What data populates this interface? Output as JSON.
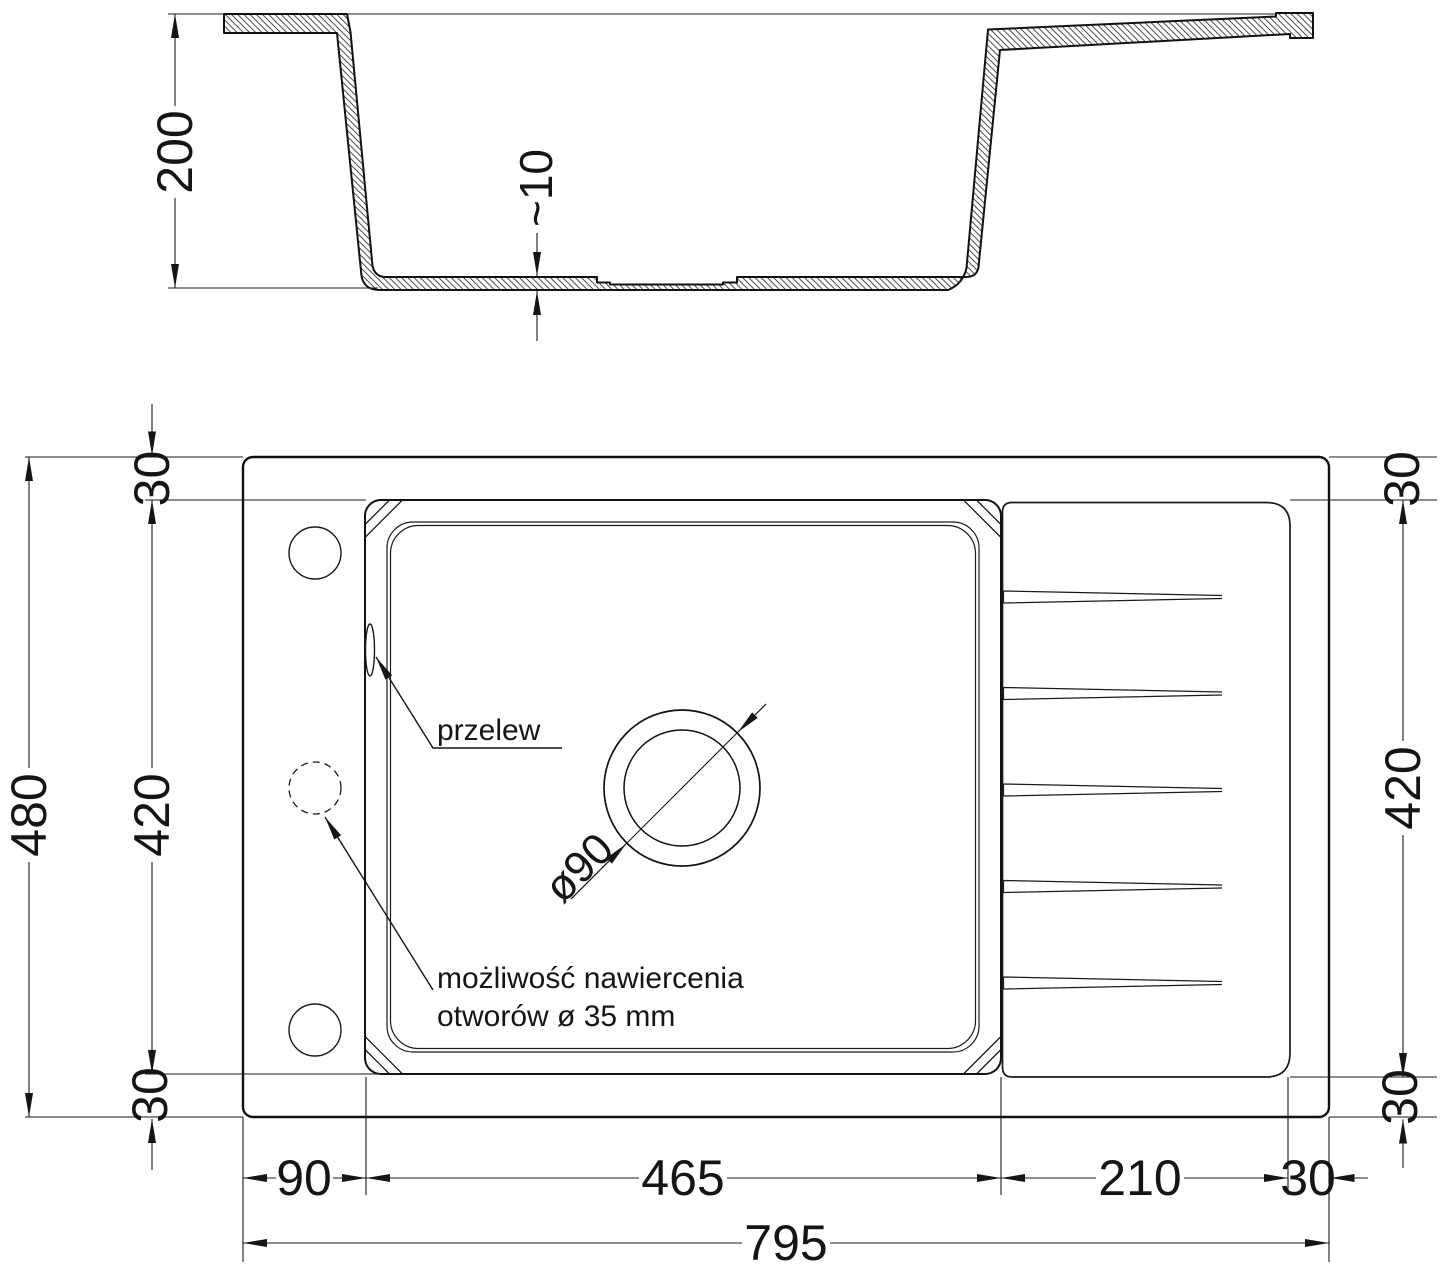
{
  "meta": {
    "drawing_type": "sink technical drawing",
    "line_color": "#151515",
    "background_color": "#ffffff"
  },
  "section": {
    "height": "200",
    "bottom_thickness": "~10"
  },
  "plan": {
    "left": {
      "overall": "480",
      "edge_top": "30",
      "bowl": "420",
      "edge_bottom": "30"
    },
    "right": {
      "edge_top": "30",
      "drainboard": "420",
      "edge_bottom": "30"
    },
    "bottom": {
      "left_offset": "90",
      "bowl_width": "465",
      "drainboard_width": "210",
      "right_margin": "30",
      "overall": "795"
    },
    "drain": {
      "diameter": "ø90"
    },
    "labels": {
      "overflow": "przelew",
      "drill_note_line1": "możliwość nawiercenia",
      "drill_note_line2": "otworów ø 35 mm"
    }
  }
}
